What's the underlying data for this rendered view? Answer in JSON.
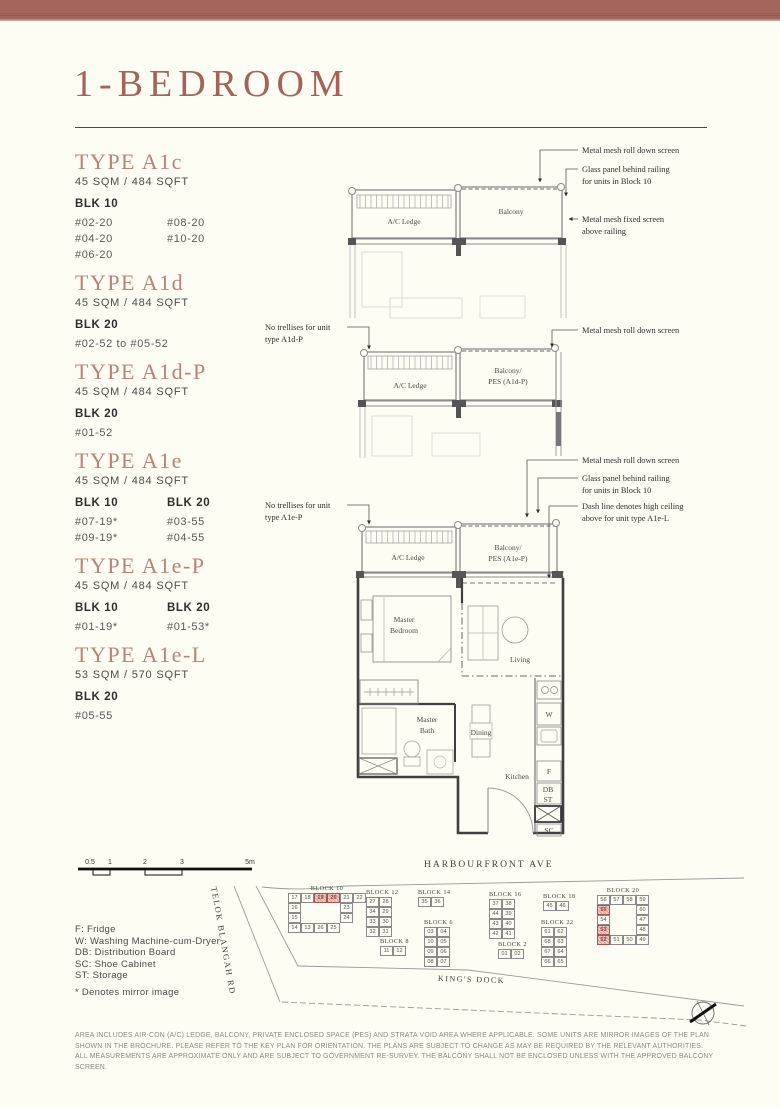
{
  "page": {
    "title": "1-BEDROOM"
  },
  "types": [
    {
      "name": "TYPE A1c",
      "area": "45 SQM / 484 SQFT",
      "columns": [
        {
          "blk": "BLK 10",
          "units": [
            "#02-20",
            "#04-20",
            "#06-20"
          ]
        },
        {
          "blk": "",
          "units": [
            "#08-20",
            "#10-20"
          ]
        }
      ]
    },
    {
      "name": "TYPE A1d",
      "area": "45 SQM / 484 SQFT",
      "columns": [
        {
          "blk": "BLK 20",
          "units": [
            "#02-52 to #05-52"
          ]
        }
      ]
    },
    {
      "name": "TYPE A1d-P",
      "area": "45 SQM / 484 SQFT",
      "columns": [
        {
          "blk": "BLK 20",
          "units": [
            "#01-52"
          ]
        }
      ]
    },
    {
      "name": "TYPE A1e",
      "area": "45 SQM / 484 SQFT",
      "columns": [
        {
          "blk": "BLK 10",
          "units": [
            "#07-19*",
            "#09-19*"
          ]
        },
        {
          "blk": "BLK 20",
          "units": [
            "#03-55",
            "#04-55"
          ]
        }
      ]
    },
    {
      "name": "TYPE A1e-P",
      "area": "45 SQM / 484 SQFT",
      "columns": [
        {
          "blk": "BLK 10",
          "units": [
            "#01-19*"
          ]
        },
        {
          "blk": "BLK 20",
          "units": [
            "#01-53*"
          ]
        }
      ]
    },
    {
      "name": "TYPE A1e-L",
      "area": "53 SQM / 570 SQFT",
      "columns": [
        {
          "blk": "BLK 20",
          "units": [
            "#05-55"
          ]
        }
      ]
    }
  ],
  "plans": {
    "a1c": {
      "ac_ledge": "A/C Ledge",
      "balcony": "Balcony"
    },
    "a1d": {
      "ac_ledge": "A/C Ledge",
      "balcony_line1": "Balcony/",
      "balcony_line2": "PES (A1d-P)"
    },
    "a1e": {
      "ac_ledge": "A/C Ledge",
      "balcony_line1": "Balcony/",
      "balcony_line2": "PES (A1e-P)",
      "master_bedroom_line1": "Master",
      "master_bedroom_line2": "Bedroom",
      "living": "Living",
      "master_bath_line1": "Master",
      "master_bath_line2": "Bath",
      "dining": "Dining",
      "kitchen": "Kitchen",
      "w": "W",
      "f": "F",
      "db": "DB",
      "st": "ST",
      "sc": "SC"
    }
  },
  "annotations": {
    "a1c": [
      {
        "lines": [
          "Metal mesh roll down screen"
        ]
      },
      {
        "lines": [
          "Glass panel behind railing",
          "for units in Block 10"
        ]
      },
      {
        "lines": [
          "Metal mesh fixed screen",
          "above railing"
        ]
      }
    ],
    "a1d": {
      "left": {
        "lines": [
          "No trellises for unit",
          "type A1d-P"
        ]
      },
      "right": {
        "lines": [
          "Metal mesh roll down screen"
        ]
      }
    },
    "a1e": {
      "left": {
        "lines": [
          "No trellises for unit",
          "type A1e-P"
        ]
      },
      "right": [
        {
          "lines": [
            "Metal mesh roll down screen"
          ]
        },
        {
          "lines": [
            "Glass panel behind railing",
            "for units in Block 10"
          ]
        },
        {
          "lines": [
            "Dash line denotes high ceiling",
            "above for unit type A1e-L"
          ]
        }
      ]
    }
  },
  "scalebar": {
    "labels": [
      "0.5",
      "1",
      "2",
      "3",
      "5m"
    ]
  },
  "legend": {
    "items": [
      "F: Fridge",
      "W: Washing Machine-cum-Dryer",
      "DB: Distribution Board",
      "SC: Shoe Cabinet",
      "ST: Storage"
    ],
    "mirror_note": "* Denotes mirror image"
  },
  "sitemap": {
    "roads": {
      "top": "HARBOURFRONT AVE",
      "left": "TELOK BLANGAH RD",
      "bottom": "KING'S DOCK"
    },
    "highlight_color": "#a8544c",
    "blocks": [
      {
        "name": "BLOCK 10",
        "x": 288,
        "y": 885,
        "rows": [
          [
            "17",
            "18",
            "19",
            "20",
            "21",
            "22"
          ],
          [
            "16",
            "",
            "",
            "",
            "23",
            ""
          ],
          [
            "15",
            "",
            "",
            "",
            "24",
            ""
          ],
          [
            "14",
            "13",
            "26",
            "25",
            "",
            ""
          ]
        ],
        "highlighted": [
          "19",
          "20"
        ]
      },
      {
        "name": "BLOCK 12",
        "x": 366,
        "y": 889,
        "rows": [
          [
            "27",
            "28"
          ],
          [
            "34",
            "29"
          ],
          [
            "33",
            "30"
          ],
          [
            "32",
            "31"
          ]
        ],
        "highlighted": []
      },
      {
        "name": "BLOCK 14",
        "x": 418,
        "y": 889,
        "rows": [
          [
            "35",
            "36"
          ]
        ],
        "highlighted": []
      },
      {
        "name": "BLOCK 16",
        "x": 489,
        "y": 891,
        "rows": [
          [
            "37",
            "38"
          ],
          [
            "44",
            "39"
          ],
          [
            "43",
            "40"
          ],
          [
            "42",
            "41"
          ]
        ],
        "highlighted": []
      },
      {
        "name": "BLOCK 18",
        "x": 543,
        "y": 893,
        "rows": [
          [
            "45",
            "46"
          ]
        ],
        "highlighted": []
      },
      {
        "name": "BLOCK 20",
        "x": 597,
        "y": 887,
        "rows": [
          [
            "56",
            "57",
            "58",
            "59"
          ],
          [
            "55",
            "",
            "",
            "60"
          ],
          [
            "54",
            "",
            "",
            "47"
          ],
          [
            "53",
            "",
            "",
            "48"
          ],
          [
            "52",
            "51",
            "50",
            "49"
          ]
        ],
        "highlighted": [
          "55",
          "53",
          "52"
        ]
      },
      {
        "name": "BLOCK 6",
        "x": 424,
        "y": 919,
        "rows": [
          [
            "03",
            "04"
          ],
          [
            "10",
            "05"
          ],
          [
            "09",
            "06"
          ],
          [
            "08",
            "07"
          ]
        ],
        "highlighted": []
      },
      {
        "name": "BLOCK 8",
        "x": 380,
        "y": 938,
        "rows": [
          [
            "11",
            "12"
          ]
        ],
        "highlighted": []
      },
      {
        "name": "BLOCK 2",
        "x": 498,
        "y": 941,
        "rows": [
          [
            "01",
            "02"
          ]
        ],
        "highlighted": []
      },
      {
        "name": "BLOCK 22",
        "x": 541,
        "y": 919,
        "rows": [
          [
            "61",
            "62"
          ],
          [
            "68",
            "63"
          ],
          [
            "67",
            "64"
          ],
          [
            "66",
            "65"
          ]
        ],
        "highlighted": []
      }
    ]
  },
  "disclaimer": "AREA INCLUDES AIR-CON (A/C) LEDGE, BALCONY, PRIVATE ENCLOSED SPACE (PES) AND STRATA VOID AREA WHERE APPLICABLE. SOME UNITS ARE MIRROR IMAGES OF THE PLAN SHOWN IN THE BROCHURE. PLEASE REFER TO THE KEY PLAN FOR ORIENTATION. THE PLANS ARE SUBJECT TO CHANGE AS MAY BE REQUIRED BY THE RELEVANT AUTHORITIES. ALL MEASUREMENTS ARE APPROXIMATE ONLY AND ARE SUBJECT TO GOVERNMENT RE-SURVEY. THE BALCONY SHALL NOT BE ENCLOSED UNLESS WITH THE APPROVED BALCONY SCREEN."
}
